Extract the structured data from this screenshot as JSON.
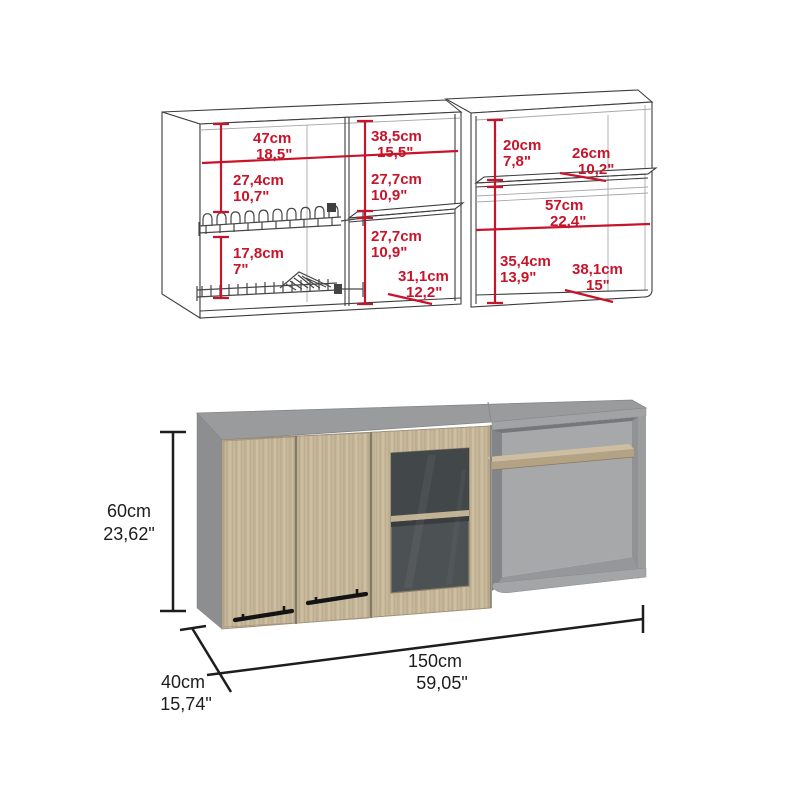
{
  "figure": {
    "kind": "kitchen wall cabinet dimension diagram",
    "background": "#ffffff"
  },
  "colors": {
    "dimension_red": "#c8142a",
    "dimension_black": "#1d1d1d",
    "wireframe": "#3d3d3d",
    "cabinet_gray_top": "#9a9b9d",
    "cabinet_gray_side": "#8d8e90",
    "cabinet_gray_back": "#a7a8aa",
    "wood": "#c6b79a",
    "glass": "#4c5154",
    "handle_black": "#141414"
  },
  "top_view": {
    "left_cabinet": {
      "width": {
        "cm": "47cm",
        "in": "18,5\""
      },
      "top_to_rack": {
        "cm": "27,4cm",
        "in": "10,7\""
      },
      "between_racks": {
        "cm": "17,8cm",
        "in": "7\""
      },
      "center_width": {
        "cm": "38,5cm",
        "in": "15,5\""
      },
      "center_upper_height": {
        "cm": "27,7cm",
        "in": "10,9\""
      },
      "center_lower_height": {
        "cm": "27,7cm",
        "in": "10,9\""
      },
      "center_depth": {
        "cm": "31,1cm",
        "in": "12,2\""
      }
    },
    "right_cabinet": {
      "upper_height": {
        "cm": "20cm",
        "in": "7,8\""
      },
      "shelf_depth": {
        "cm": "26cm",
        "in": "10,2\""
      },
      "interior_width": {
        "cm": "57cm",
        "in": "22,4\""
      },
      "lower_height": {
        "cm": "35,4cm",
        "in": "13,9\""
      },
      "bottom_depth": {
        "cm": "38,1cm",
        "in": "15\""
      }
    }
  },
  "render_view": {
    "height": {
      "cm": "60cm",
      "in": "23,62\""
    },
    "depth": {
      "cm": "40cm",
      "in": "15,74\""
    },
    "width": {
      "cm": "150cm",
      "in": "59,05\""
    }
  }
}
